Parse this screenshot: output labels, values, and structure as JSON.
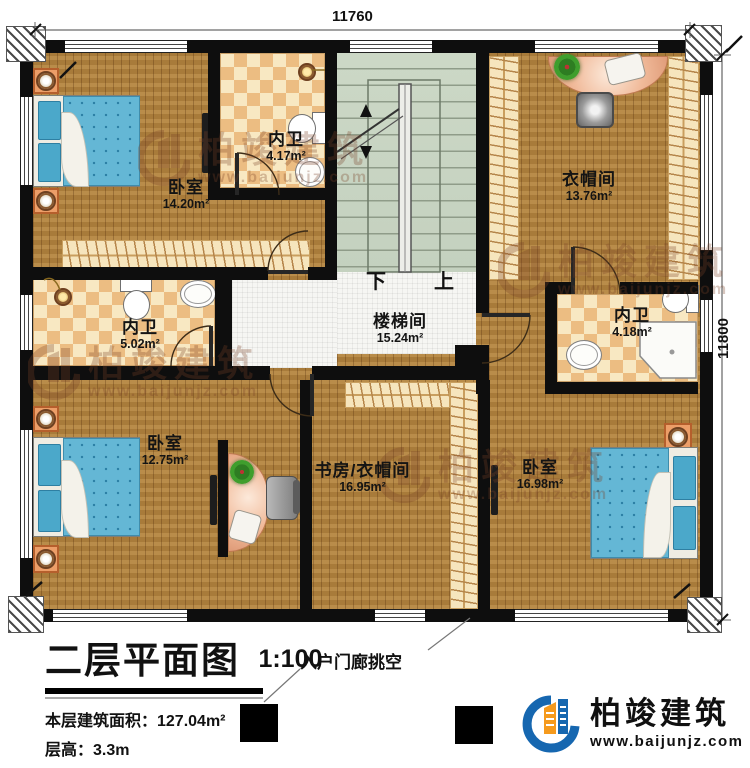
{
  "plan": {
    "dimensions": {
      "top": "11760",
      "right": "11800"
    },
    "stairs": {
      "down": "下",
      "up": "上"
    }
  },
  "rooms": [
    {
      "id": "bedroom-1",
      "name": "卧室",
      "area": "14.20m²"
    },
    {
      "id": "bath-1",
      "name": "内卫",
      "area": "4.17m²"
    },
    {
      "id": "cloakroom",
      "name": "衣帽间",
      "area": "13.76m²"
    },
    {
      "id": "bath-2",
      "name": "内卫",
      "area": "5.02m²"
    },
    {
      "id": "stairwell",
      "name": "楼梯间",
      "area": "15.24m²"
    },
    {
      "id": "bath-3",
      "name": "内卫",
      "area": "4.18m²"
    },
    {
      "id": "bedroom-2",
      "name": "卧室",
      "area": "12.75m²"
    },
    {
      "id": "study-cloak",
      "name": "书房/衣帽间",
      "area": "16.95m²"
    },
    {
      "id": "bedroom-3",
      "name": "卧室",
      "area": "16.98m²"
    }
  ],
  "title_block": {
    "title": "二层平面图",
    "scale": "1:100",
    "floor_area": "本层建筑面积：127.04m²",
    "floor_height": "层高：3.3m"
  },
  "annotations": {
    "porch_void": "入户门廊挑空"
  },
  "logo": {
    "name": "柏竣建筑",
    "url": "www.baijunjz.com"
  },
  "watermark": {
    "text": "柏竣建筑",
    "url": "www.baijunjz.com"
  },
  "colors": {
    "wall": "#0e0e0e",
    "wood": "#b1833f",
    "tileblue": "#64b7d5",
    "checker": "#ecbd82",
    "stair": "#ccd8c6",
    "brand_blue": "#1667b0",
    "brand_orange": "#f59a1d"
  }
}
